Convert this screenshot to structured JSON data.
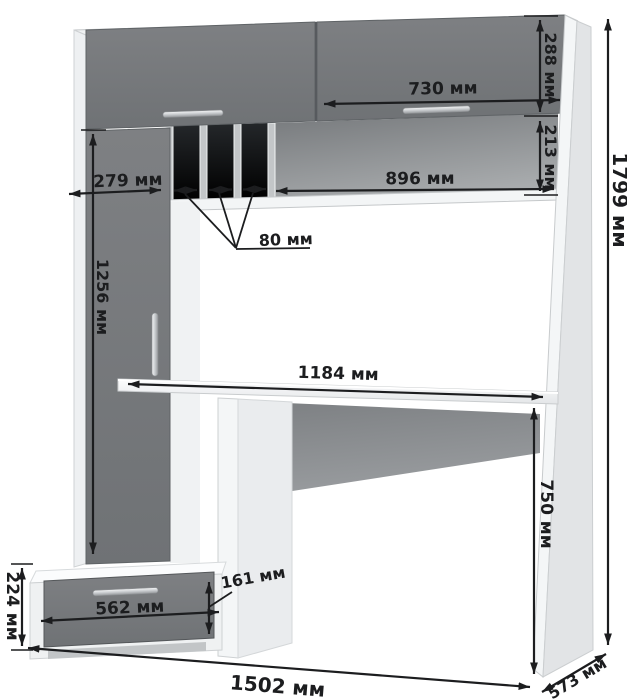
{
  "diagram": {
    "kind": "furniture-dimension-drawing",
    "subject": "computer desk with hutch, drawer pedestal and CD slots",
    "unit": "мм"
  },
  "dims": {
    "top_door_height": {
      "value": 288,
      "label": "288 мм"
    },
    "top_door_width": {
      "value": 730,
      "label": "730 мм"
    },
    "niche_height": {
      "value": 213,
      "label": "213 мм"
    },
    "niche_width": {
      "value": 896,
      "label": "896 мм"
    },
    "left_column_width": {
      "value": 279,
      "label": "279 мм"
    },
    "slot_width": {
      "value": 80,
      "label": "80 мм"
    },
    "left_door_height": {
      "value": 1256,
      "label": "1256 мм"
    },
    "desktop_length": {
      "value": 1184,
      "label": "1184 мм"
    },
    "total_height": {
      "value": 1799,
      "label": "1799 мм"
    },
    "desk_height": {
      "value": 750,
      "label": "750 мм"
    },
    "drawer_unit_height": {
      "value": 224,
      "label": "224 мм"
    },
    "drawer_front_height": {
      "value": 161,
      "label": "161 мм"
    },
    "drawer_width": {
      "value": 562,
      "label": "562 мм"
    },
    "total_width": {
      "value": 1502,
      "label": "1502 мм"
    },
    "total_depth": {
      "value": 573,
      "label": "573 мм"
    }
  },
  "colors": {
    "background": "#ffffff",
    "front_gray": "#76787b",
    "carcass_white": "#f2f4f5",
    "recess_dark": "#2e3134",
    "handle_silver": "#c9cccf",
    "dimension_ink": "#1c1d1f"
  }
}
